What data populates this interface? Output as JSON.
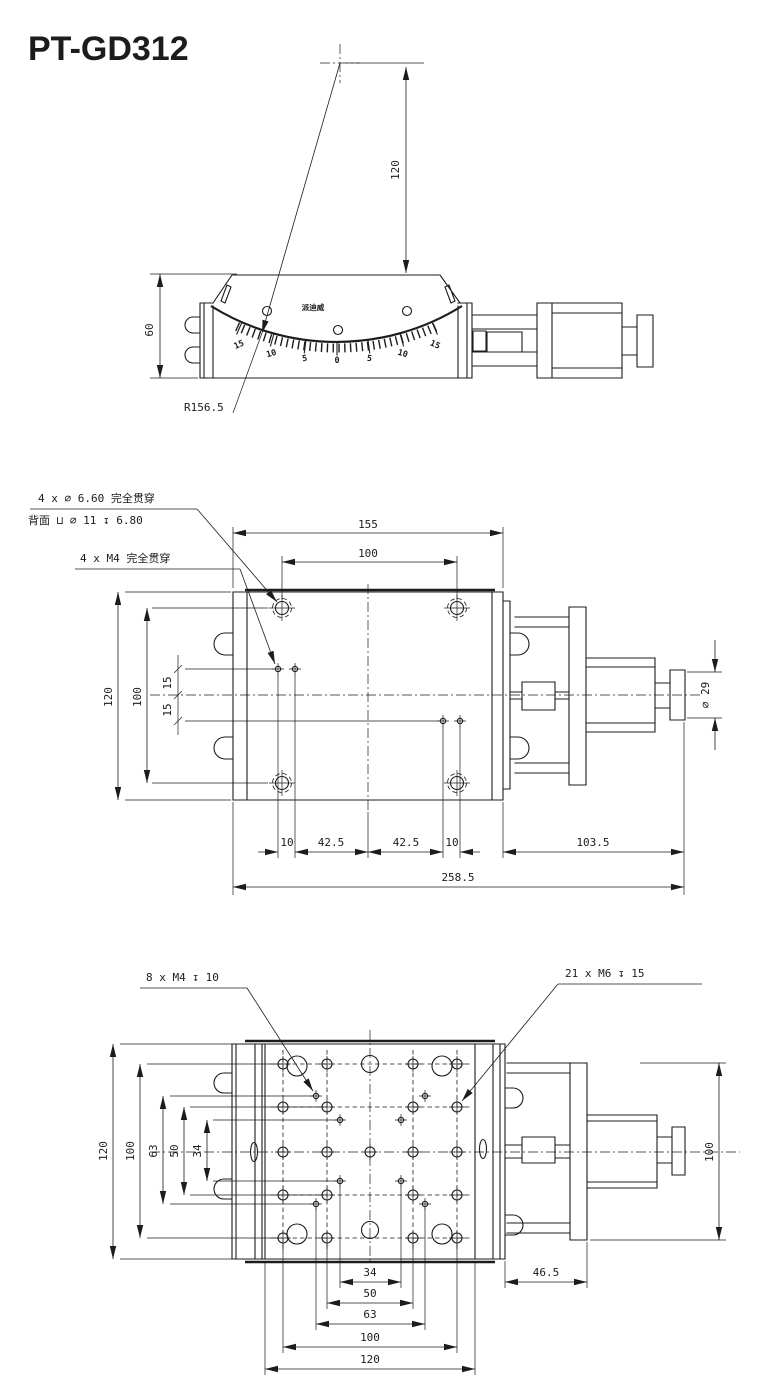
{
  "title": "PT-GD312",
  "colors": {
    "line": "#1c1c1c",
    "background": "#ffffff"
  },
  "front_view": {
    "height": "60",
    "pivot_height": "120",
    "radius": "R156.5",
    "brand": "派迪威",
    "scale": [
      "15",
      "10",
      "5",
      "0",
      "5",
      "10",
      "15"
    ]
  },
  "top_view": {
    "callout_cbore_1": "4 x ⌀ 6.60 完全贯穿",
    "callout_cbore_2": "背面 ⊔ ⌀ 11 ↧ 6.80",
    "callout_m4": "4 x M4 完全贯穿",
    "width": "155",
    "hole_span_x": "100",
    "height": "120",
    "hole_span_y": "100",
    "offset_top": "15",
    "offset_bottom": "15",
    "chain": [
      "10",
      "42.5",
      "42.5",
      "10"
    ],
    "actuator_length": "103.5",
    "overall_length": "258.5",
    "knob_diameter": "⌀ 29"
  },
  "bottom_view": {
    "callout_m4": "8 x M4 ↧ 10",
    "callout_m6": "21 x M6 ↧ 15",
    "left_dims": [
      "120",
      "100",
      "63",
      "50",
      "34"
    ],
    "bottom_dims": [
      "34",
      "50",
      "63",
      "100",
      "120"
    ],
    "bracket_offset": "46.5",
    "actuator_height": "100"
  }
}
